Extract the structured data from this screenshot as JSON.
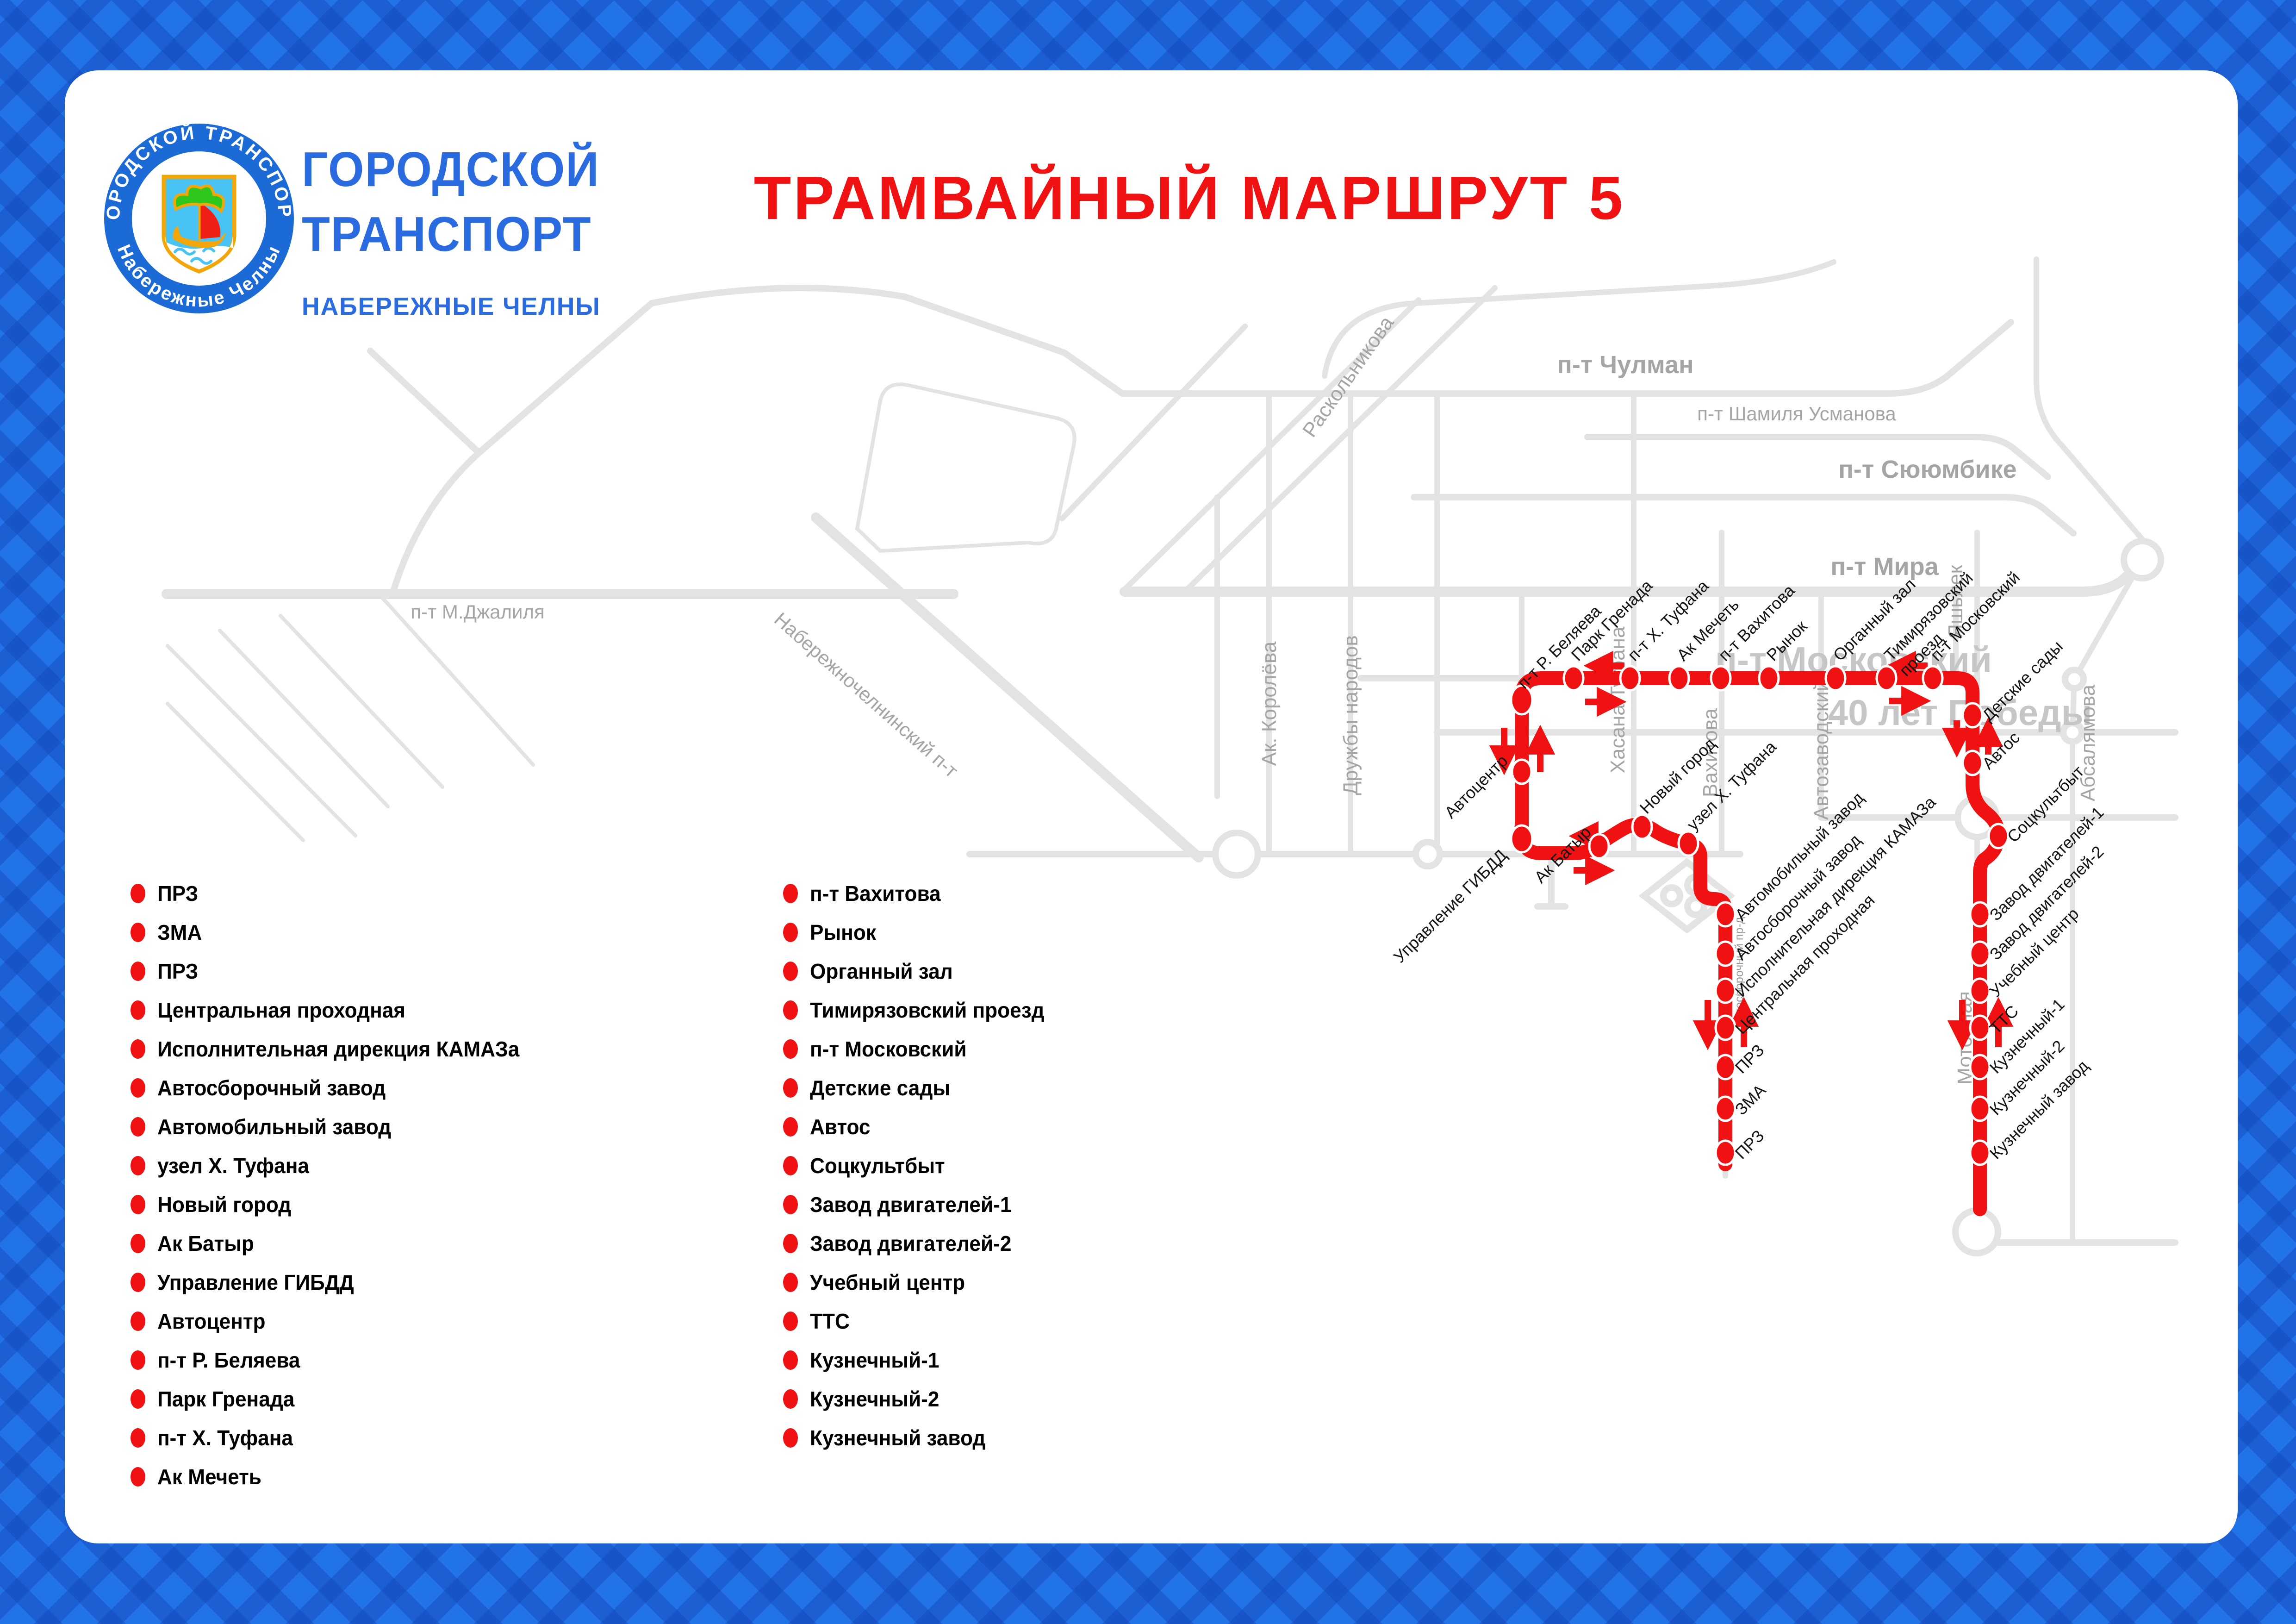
{
  "title": "ТРАМВАЙНЫЙ МАРШРУТ 5",
  "brand": {
    "ring_top": "ГОРОДСКОЙ ТРАНСПОРТ",
    "ring_bottom": "Набережные Челны",
    "line1": "ГОРОДСКОЙ",
    "line2": "ТРАНСПОРТ",
    "line3": "НАБЕРЕЖНЫЕ ЧЕЛНЫ"
  },
  "colors": {
    "route_red": "#f01212",
    "brand_blue": "#2b6be0",
    "frame_blue": "#2273e8",
    "frame_blue_dark": "#1c5ecf",
    "street_gray": "#e3e3e3",
    "street_label_gray": "#a5a5a5",
    "big_street_label_gray": "#c6c6c6"
  },
  "map": {
    "street_labels": [
      "Раскольникова",
      "п-т Чулман",
      "п-т Шамиля Усманова",
      "п-т Сююмбике",
      "п-т Мира",
      "п-т М.Джалиля",
      "Набережночелнинский п-т",
      "Ак. Королёва",
      "Дружбы народов",
      "Раиса Беляева",
      "Хасана Туфана",
      "Вахитова",
      "Автозаводский",
      "Яшьлек",
      "п-т Московский",
      "40 лет Победы",
      "Абсалямова",
      "Моторная",
      "Автосборочный пр-д"
    ],
    "stop_labels": [
      "п-т Р. Беляева",
      "Парк Гренада",
      "п-т Х. Туфана",
      "Ак Мечеть",
      "п-т Вахитова",
      "Рынок",
      "Органный зал",
      "Тимирязовский",
      "проезд",
      "п-т Московский",
      "Автоцентр",
      "Управление ГИБДД",
      "Ак Батыр",
      "Новый город",
      "узел Х. Туфана",
      "Автомобильный завод",
      "Автосборочный завод",
      "Исполнительная дирекция КАМАЗа",
      "Центральная проходная",
      "ПРЗ",
      "ЗМА",
      "ПРЗ",
      "Детские сады",
      "Автос",
      "Соцкультбыт",
      "Завод двигателей-1",
      "Завод двигателей-2",
      "Учебный центр",
      "ТТС",
      "Кузнечный-1",
      "Кузнечный-2",
      "Кузнечный завод"
    ]
  },
  "legend": {
    "column1": [
      "ПРЗ",
      "ЗМА",
      "ПРЗ",
      "Центральная проходная",
      "Исполнительная дирекция КАМАЗа",
      "Автосборочный завод",
      "Автомобильный завод",
      "узел Х. Туфана",
      "Новый город",
      "Ак Батыр",
      "Управление ГИБДД",
      "Автоцентр",
      "п-т Р. Беляева",
      "Парк Гренада",
      "п-т Х. Туфана",
      "Ак Мечеть"
    ],
    "column2": [
      "п-т Вахитова",
      "Рынок",
      "Органный зал",
      "Тимирязовский проезд",
      "п-т Московский",
      "Детские сады",
      "Автос",
      "Соцкультбыт",
      "Завод двигателей-1",
      "Завод двигателей-2",
      "Учебный центр",
      "ТТС",
      "Кузнечный-1",
      "Кузнечный-2",
      "Кузнечный завод"
    ]
  }
}
